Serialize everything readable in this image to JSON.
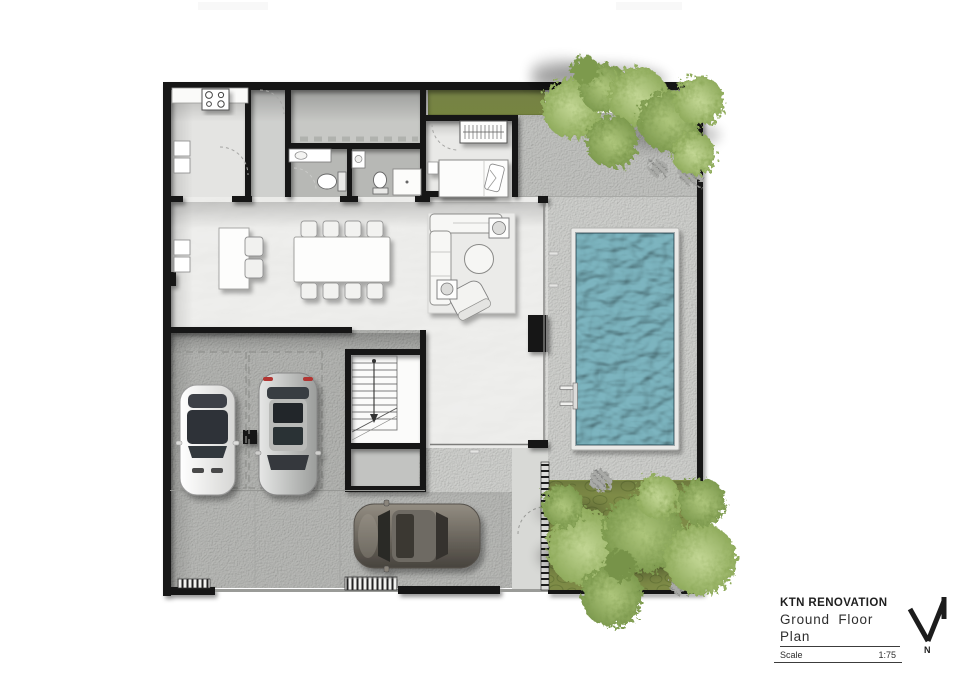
{
  "title_block": {
    "project": "KTN RENOVATION",
    "drawing": "Ground Floor Plan",
    "scale_label": "Scale",
    "scale_value": "1:75",
    "north_label": "N"
  },
  "icons": {
    "north_arrow": "north-arrow-icon"
  },
  "colors": {
    "paper": "#ffffff",
    "wall": "#171717",
    "marble": "#f3f3f1",
    "room-gray": "#c7c8c5",
    "utility-gray": "#cfd0ce",
    "bath-gray": "#b7b8b5",
    "bedroom-floor": "#e9e9e7",
    "kitchen-floor": "#e4e4e2",
    "terrace": "#c2c3c0",
    "deck": "#cfd0cd",
    "concrete": "#b4b5b2",
    "driveway": "#b8b9b6",
    "walkway": "#d8d9d6",
    "stair-floor": "#fbfbfa",
    "store-gray": "#c2c3c1",
    "pool-water": "#7db5c0",
    "pool-coping": "#e9e9e7",
    "grass": "#8a9a4f",
    "garden": "#7e8b47",
    "foliage": "#9cb96b",
    "title-text": "#1f1f1f"
  }
}
